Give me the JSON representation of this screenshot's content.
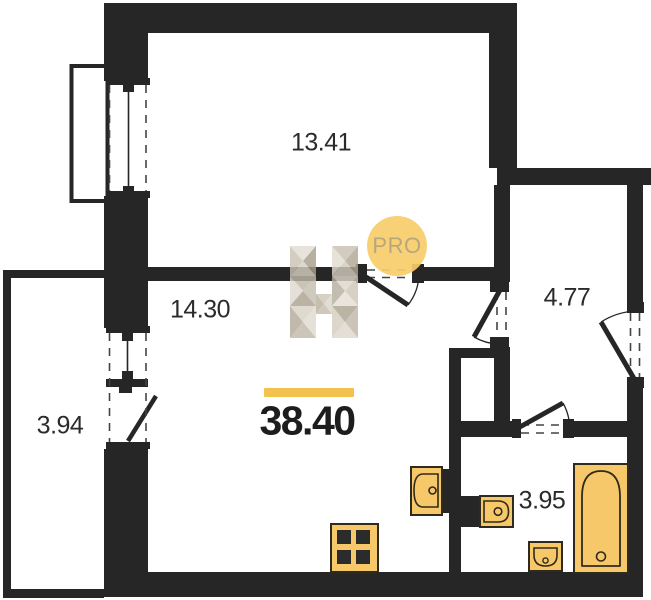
{
  "plan": {
    "type": "apartment-floor-plan",
    "total": {
      "area": "38.40"
    },
    "rooms": [
      {
        "name": "room-top",
        "area": "13.41"
      },
      {
        "name": "room-kitchen",
        "area": "14.30"
      },
      {
        "name": "balcony-left",
        "area": "3.94"
      },
      {
        "name": "hallway",
        "area": "4.77"
      },
      {
        "name": "bathroom",
        "area": "3.95"
      }
    ],
    "watermark": {
      "badge_label": "PRO",
      "logo": "h-facet-logo"
    },
    "colors": {
      "wall": "#262626",
      "fixture_fill": "#F6C869",
      "fixture_stroke": "#2F2A1C",
      "accent": "#F2C14E",
      "badge_bg": "#F7CD6A",
      "badge_text": "#B2A47C",
      "label_text": "#2B2B2B"
    }
  }
}
